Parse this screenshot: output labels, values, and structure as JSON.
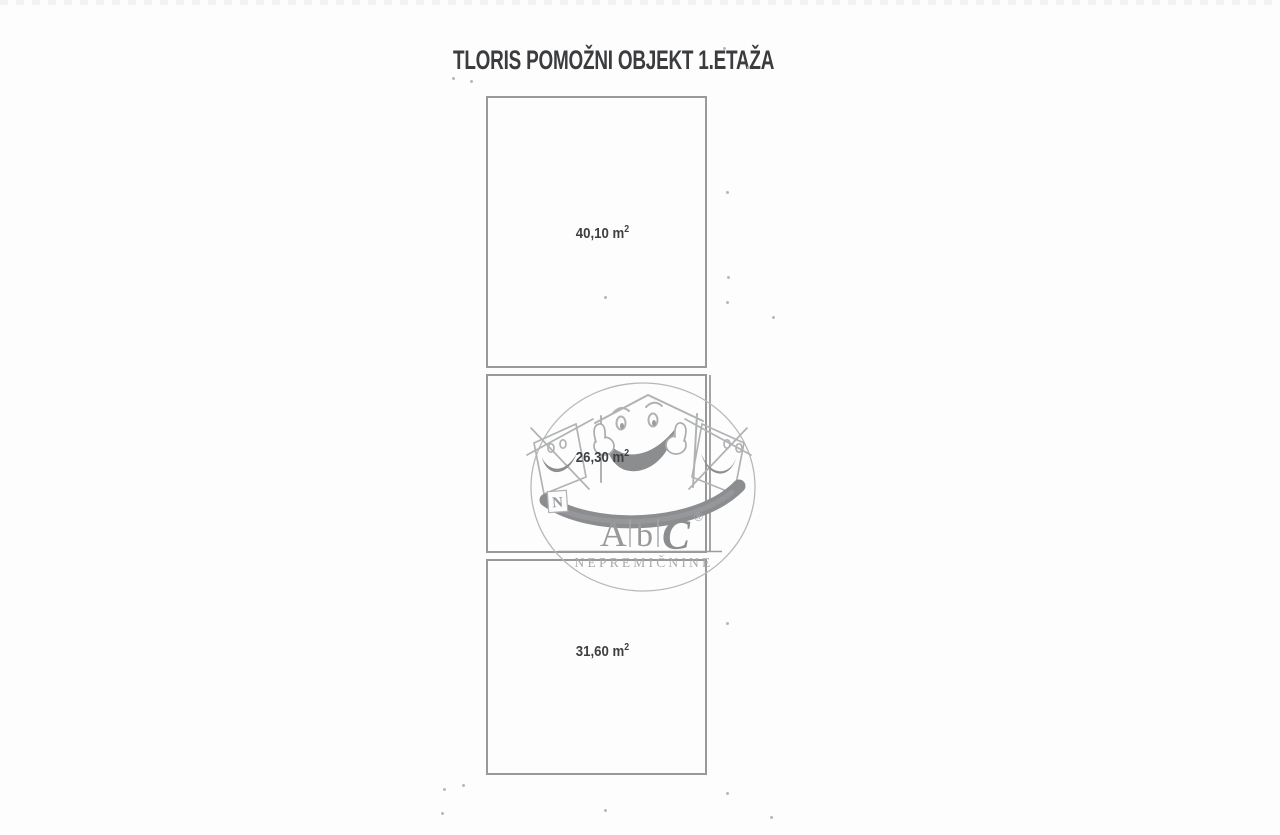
{
  "title": "TLORIS POMOŽNI OBJEKT 1.ETAŽA",
  "rooms": [
    {
      "id": "room-1",
      "area_value": "40,10",
      "unit": "m",
      "exponent": "2"
    },
    {
      "id": "room-2",
      "area_value": "26,30",
      "unit": "m",
      "exponent": "2"
    },
    {
      "id": "room-3",
      "area_value": "31,60",
      "unit": "m",
      "exponent": "2"
    }
  ],
  "watermark": {
    "letter_a": "A",
    "letter_b": "b",
    "letter_c": "C",
    "registered_mark": "®",
    "subtitle": "NEPREMIČNINE",
    "badge_letter": "N"
  },
  "colors": {
    "wall_line": "#97999b",
    "label_text": "#3d3f41",
    "title_text": "#3a3c3e",
    "watermark_light": "#b3b5b7",
    "watermark_dark": "#8b8d8f"
  }
}
